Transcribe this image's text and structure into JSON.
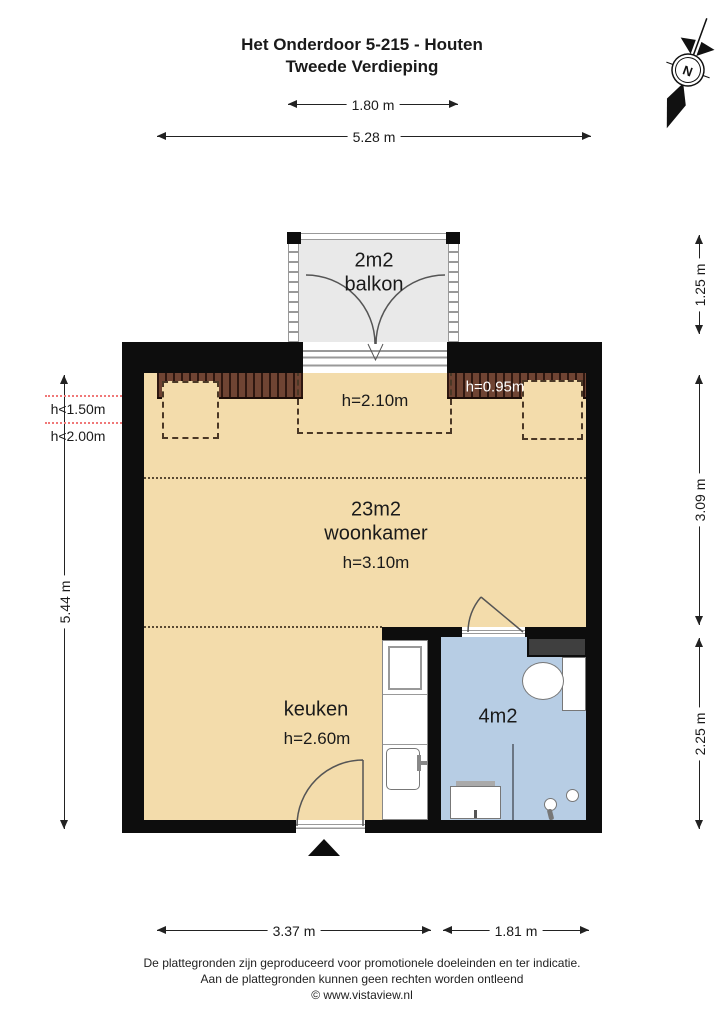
{
  "title": {
    "line1": "Het Onderdoor 5-215 - Houten",
    "line2": "Tweede Verdieping"
  },
  "compass": {
    "label": "N"
  },
  "dimensions": {
    "top_small": "1.80 m",
    "top_large": "5.28 m",
    "left_total": "5.44 m",
    "right_balcony": "1.25 m",
    "right_middle": "3.09 m",
    "right_bottom": "2.25 m",
    "bottom_left": "3.37 m",
    "bottom_right": "1.81 m"
  },
  "rooms": {
    "balcony_area": "2m2",
    "balcony_name": "balkon",
    "living_area": "23m2",
    "living_name": "woonkamer",
    "living_height": "h=3.10m",
    "kitchen_name": "keuken",
    "kitchen_height": "h=2.60m",
    "bathroom_area": "4m2"
  },
  "height_annotations": {
    "dormer_zone": "h=2.10m",
    "knee_wall": "h=0.95m",
    "left_low_1": "h<1.50m",
    "left_low_2": "h<2.00m"
  },
  "footer": {
    "line1": "De plattegronden zijn geproduceerd voor promotionele doeleinden en ter indicatie.",
    "line2": "Aan de plattegronden kunnen geen rechten worden ontleend",
    "line3": "© www.vistaview.nl"
  },
  "colors": {
    "floor": "#f3dcab",
    "bath": "#b7cde4",
    "balcony": "#e9e9e9",
    "wall": "#0d0d0d",
    "red": "#f07878"
  }
}
